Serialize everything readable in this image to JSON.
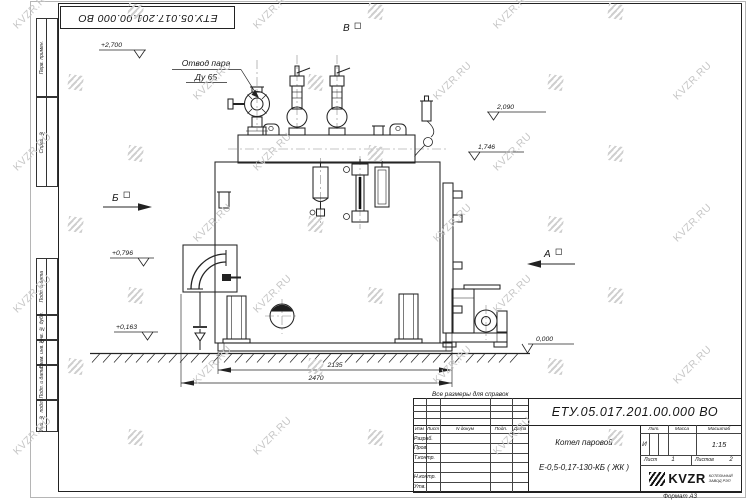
{
  "watermark": {
    "text": "KVZR.RU"
  },
  "frame": {
    "top_designation": "ЕТУ.05.017.201.00.000  ВО",
    "margin_stamps": [
      "Перв. примен.",
      "Справ. №",
      "Подп. и дата",
      "Инв. № дубл.",
      "Взам. инв. №",
      "Подп. и дата",
      "Инв. № подл."
    ]
  },
  "drawing": {
    "note": "Все размеры для справок",
    "callout": {
      "line1": "Отвод пара",
      "line2": "Ду 65"
    },
    "views": {
      "top": "В",
      "left": "Б",
      "right": "А"
    },
    "elevations": {
      "top_left": "+2,700",
      "right_upper": "2,090",
      "right_lower": "1,746",
      "left_upper": "+0,796",
      "left_lower": "+0,163",
      "ground": "0,000"
    },
    "dimensions": {
      "inner": "2135",
      "overall": "2470"
    }
  },
  "titleblock": {
    "designation": "ЕТУ.05.017.201.00.000  ВО",
    "product_line1": "Котел паровой",
    "product_line2": "Е-0,5-0,17-130-КБ ( ЖК )",
    "cols": {
      "izm": "Изм",
      "list": "Лист",
      "ndokum": "N докум",
      "podp": "Подп.",
      "data": "Дата"
    },
    "rows": {
      "r1": "Разраб.",
      "r2": "Пров.",
      "r3": "Т.контр.",
      "r4": "",
      "r5": "Н.контр.",
      "r6": "Утв."
    },
    "lit": {
      "label": "Лит.",
      "value": "И"
    },
    "massa": {
      "label": "Масса",
      "value": ""
    },
    "scale": {
      "label": "Масштаб",
      "value": "1:15"
    },
    "sheet": {
      "label": "Лист",
      "value": "1"
    },
    "sheets": {
      "label": "Листов",
      "value": "2"
    },
    "logo": {
      "text": "KVZR",
      "sub1": "КОТЕЛЬНЫЙ",
      "sub2": "ЗАВОД РЭП"
    },
    "format": "Формат А3"
  }
}
